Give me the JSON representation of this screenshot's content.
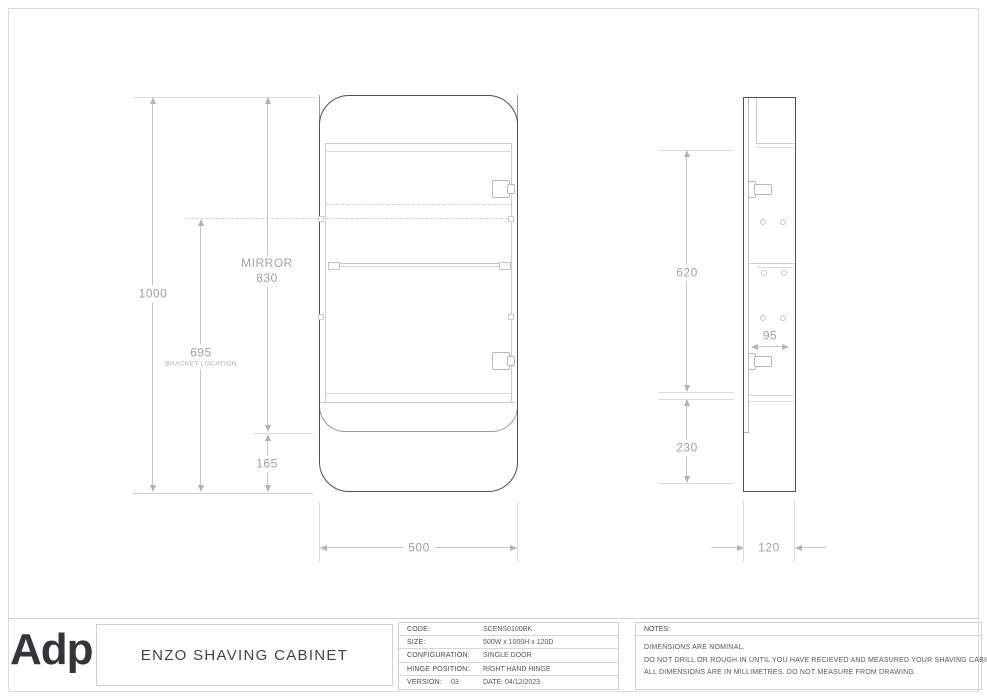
{
  "drawing": {
    "front": {
      "dim_total_height": "1000",
      "dim_bracket_value": "695",
      "dim_bracket_label": "BRACKET LOCATION",
      "dim_mirror_label": "MIRROR",
      "dim_mirror_value": "830",
      "dim_bottom_shelf": "165",
      "dim_width": "500"
    },
    "side": {
      "dim_interior_height": "620",
      "dim_open_shelf_height": "230",
      "dim_interior_depth": "95",
      "dim_depth": "120"
    }
  },
  "footer": {
    "logo_text": "Adp",
    "product_title": "ENZO SHAVING CABINET",
    "specs": [
      {
        "label": "CODE:",
        "value": "SCENS0100BK"
      },
      {
        "label": "SIZE:",
        "value": "500W x 1000H x 120D"
      },
      {
        "label": "CONFIGURATION:",
        "value": "SINGLE DOOR"
      },
      {
        "label": "HINGE POSITION:",
        "value": "RIGHT HAND HINGE"
      },
      {
        "label": "VERSION:",
        "version": "03",
        "value": "DATE: 04/12/2023"
      }
    ],
    "notes": {
      "header": "NOTES:",
      "lines": [
        "DIMENSIONS ARE NOMINAL.",
        "DO NOT DRILL OR ROUGH IN UNTIL YOU HAVE RECIEVED AND MEASURED YOUR SHAVING CABINET.",
        "ALL DIMENSIONS ARE IN MILLIMETRES. DO NOT MEASURE FROM DRAWING."
      ]
    }
  },
  "colors": {
    "outline_dark": "#505050",
    "line_light": "#cdcdcd",
    "dim_text": "#a2a2a2",
    "footer_text": "#54575c",
    "logo_color": "#32363b"
  }
}
